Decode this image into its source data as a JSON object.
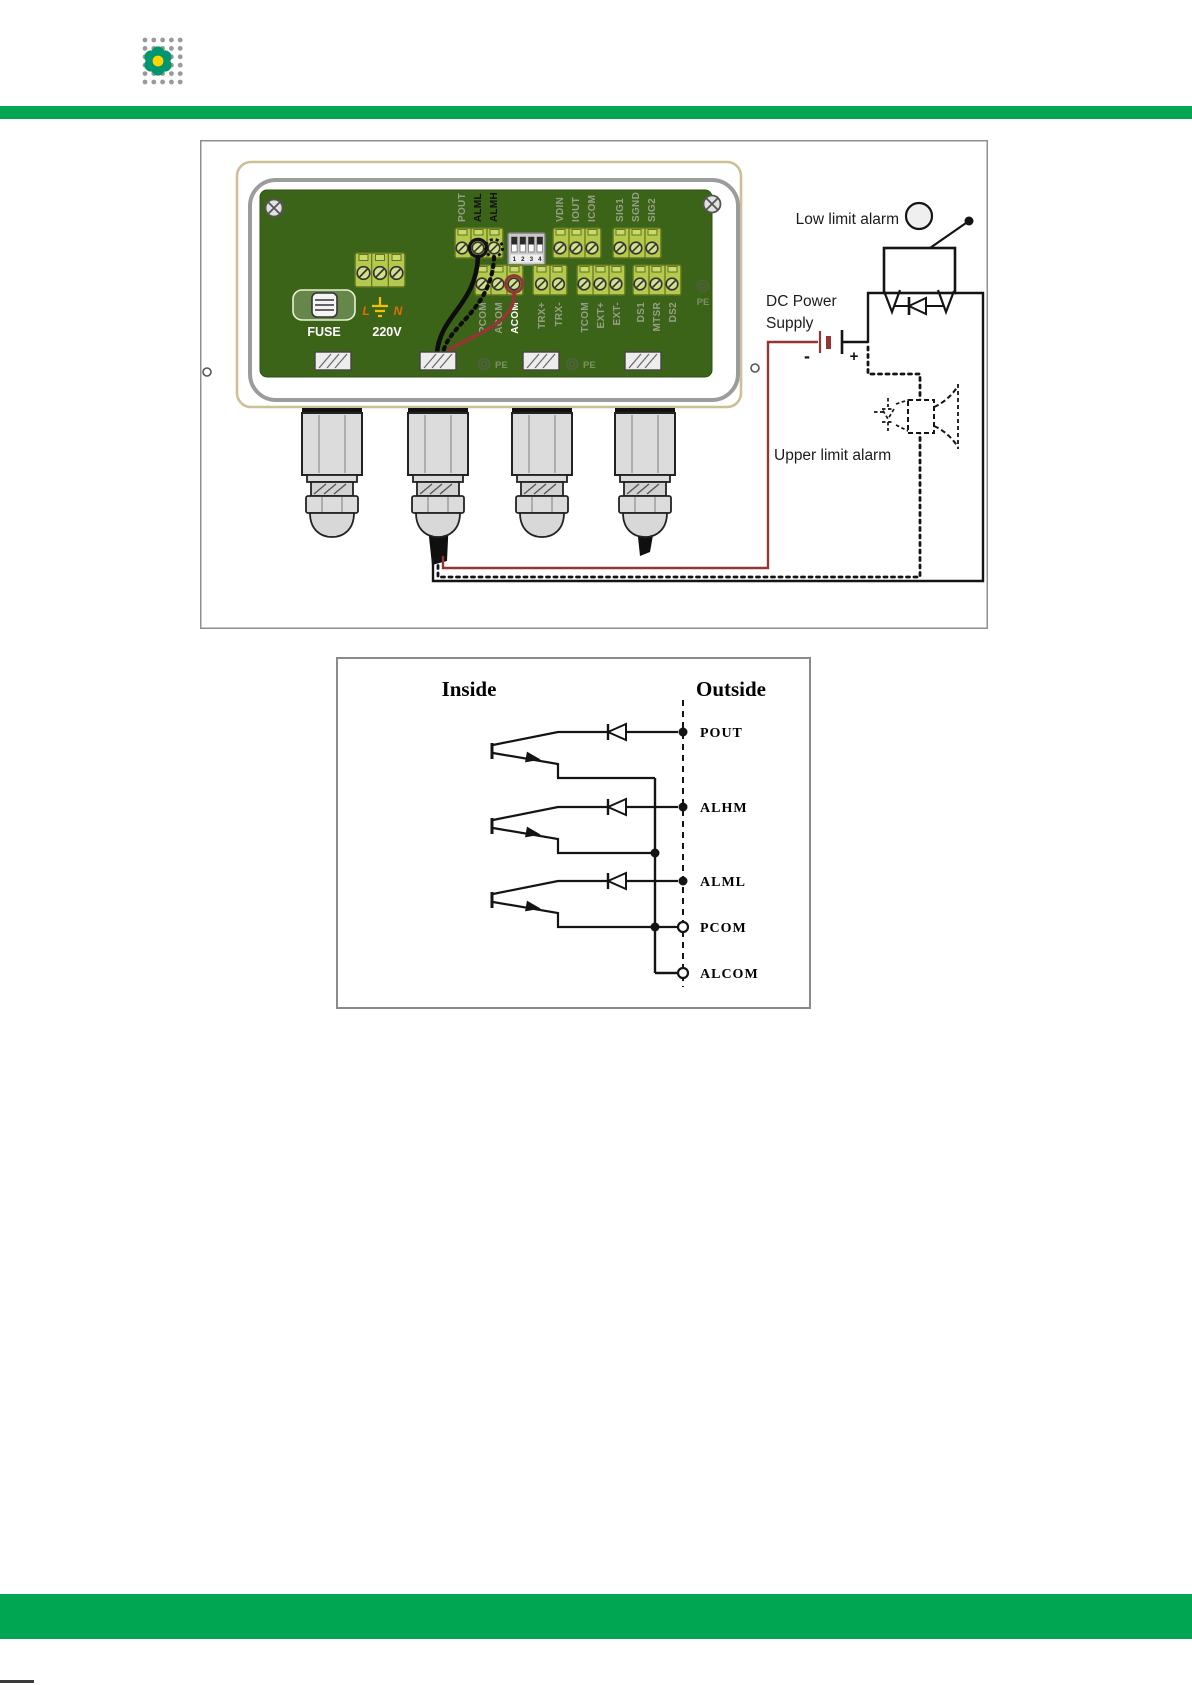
{
  "colors": {
    "accent_green": "#00a651",
    "wire_red": "#943634",
    "pcb_green": "#3c6418",
    "terminal_green": "#b5ca4c",
    "enclosure_tan": "#cbc096",
    "label_orange": "#e36c09",
    "ground_yellow": "#f5c000"
  },
  "fig1": {
    "board": {
      "fuse": "FUSE",
      "voltage": "220V",
      "line_l": "L",
      "line_n": "N",
      "pe": "PE",
      "top_terminals": [
        "POUT",
        "ALML",
        "ALMH"
      ],
      "analog_terminals": [
        "VDIN",
        "IOUT",
        "ICOM"
      ],
      "signal_terminals": [
        "SIG1",
        "SGND",
        "SIG2"
      ],
      "row2_a": [
        "PCOM",
        "ACOM",
        "ACOM"
      ],
      "row2_b": [
        "TRX+",
        "TRX-"
      ],
      "row2_c": [
        "TCOM",
        "EXT+",
        "EXT-"
      ],
      "row2_d": [
        "DS1",
        "MTSR",
        "DS2"
      ],
      "dip": [
        "1",
        "2",
        "3",
        "4"
      ]
    },
    "annotations": {
      "low_limit": "Low limit alarm",
      "dc_power_1": "DC Power",
      "dc_power_2": "Supply",
      "upper_limit": "Upper limit alarm",
      "minus": "-",
      "plus": "+"
    }
  },
  "fig2": {
    "inside": "Inside",
    "outside": "Outside",
    "pins": [
      "POUT",
      "ALHM",
      "ALML",
      "PCOM",
      "ALCOM"
    ]
  }
}
